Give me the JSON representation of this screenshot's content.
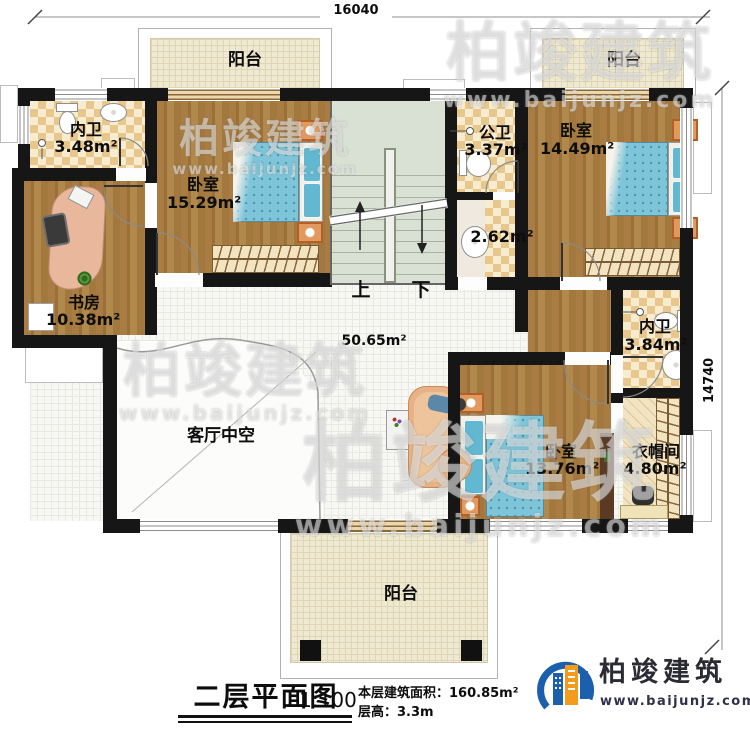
{
  "dimensions": {
    "top": "16040",
    "right": "14740"
  },
  "rooms": {
    "balcony_tl": {
      "label": "阳台"
    },
    "balcony_tr": {
      "label": "阳台"
    },
    "balcony_b": {
      "label": "阳台"
    },
    "bath_tl": {
      "label": "内卫",
      "area": "3.48m²"
    },
    "bedroom_tl": {
      "label": "卧室",
      "area": "15.29m²"
    },
    "study": {
      "label": "书房",
      "area": "10.38m²"
    },
    "public_bath": {
      "label": "公卫",
      "area": "3.37m²"
    },
    "washroom": {
      "area": "2.62m²"
    },
    "bedroom_tr": {
      "label": "卧室",
      "area": "14.49m²"
    },
    "bath_r": {
      "label": "内卫",
      "area": "3.84m²"
    },
    "hall": {
      "area": "50.65m²"
    },
    "void": {
      "label": "客厅中空"
    },
    "bedroom_b": {
      "label": "卧室",
      "area": "13.76m²"
    },
    "cloak": {
      "label": "衣帽间",
      "area": "4.80m²"
    }
  },
  "stairs": {
    "up": "上",
    "down": "下"
  },
  "titleblock": {
    "title": "二层平面图",
    "scale": "1:100",
    "area": "本层建筑面积：160.85m²",
    "floor_height": "层高：3.3m"
  },
  "brand": {
    "name": "柏竣建筑",
    "site": "www.baijunjz.com"
  },
  "watermark": {
    "name": "柏竣建筑",
    "site": "www.baijunjz.com"
  },
  "colors": {
    "wall": "#161616",
    "wood": "#a87c42",
    "bed": "#7ec5d9",
    "brand_blue": "#1b5fad",
    "brand_orange": "#f29b1d"
  }
}
